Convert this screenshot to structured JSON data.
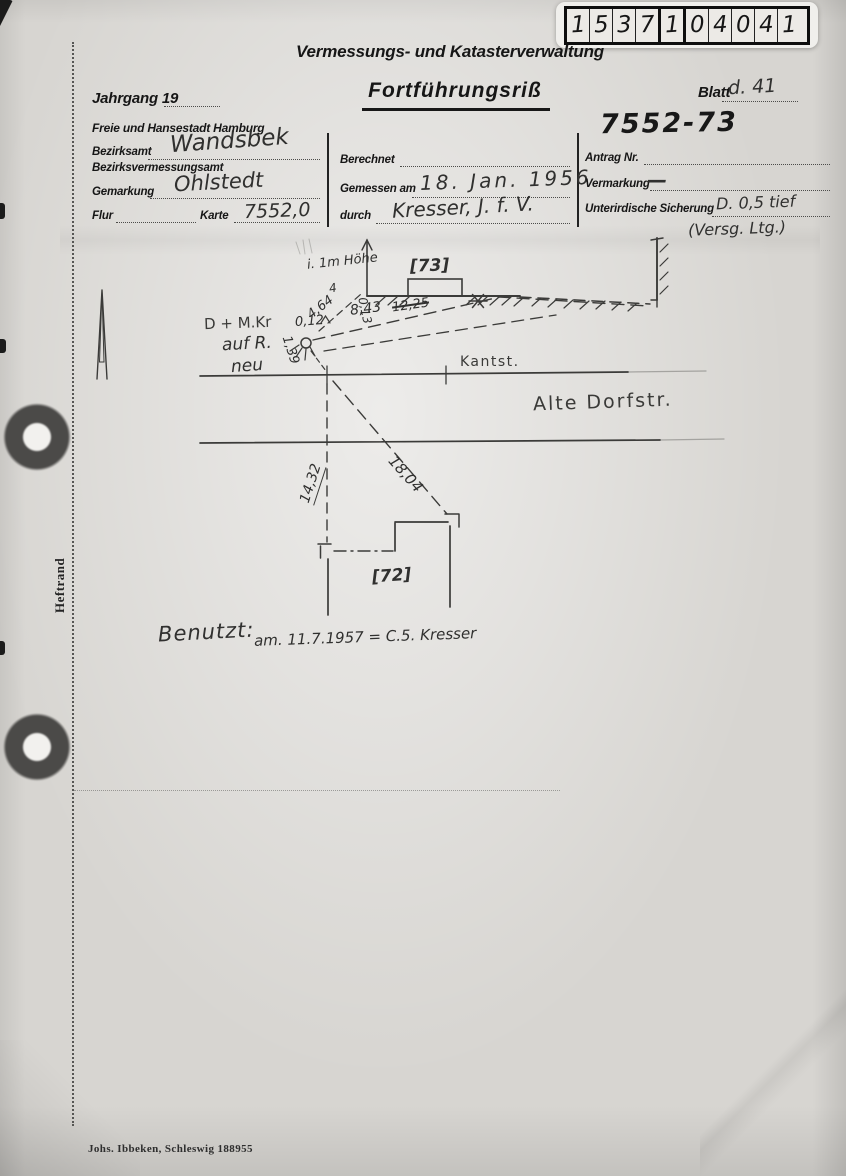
{
  "document": {
    "administration": "Vermessungs- und Katasterverwaltung",
    "jahrgang_label": "Jahrgang 19",
    "title": "Fortführungsriß",
    "blatt_label": "Blatt",
    "blatt_value": "d. 41",
    "city": "Freie und Hansestadt Hamburg",
    "file_number": "7552-73"
  },
  "stamp": {
    "digits": [
      "1",
      "5",
      "3",
      "7",
      "1",
      "0",
      "4",
      "0",
      "4",
      "1"
    ]
  },
  "form": {
    "bezirksamt_label": "Bezirksamt",
    "bezirksamt_value": "Wandsbek",
    "bezirksvermessungsamt_label": "Bezirksvermessungsamt",
    "gemarkung_label": "Gemarkung",
    "gemarkung_value": "Ohlstedt",
    "flur_label": "Flur",
    "karte_label": "Karte",
    "karte_value": "7552,0",
    "berechnet_label": "Berechnet",
    "gemessen_label": "Gemessen am",
    "gemessen_value": "18. Jan. 1956",
    "durch_label": "durch",
    "durch_value": "Kresser, J. f. V.",
    "antrag_label": "Antrag Nr.",
    "vermarkung_label": "Vermarkung",
    "vermarkung_value": "—",
    "sicherung_label": "Unterirdische Sicherung",
    "sicherung_value": "D. 0,5 tief",
    "sicherung_note": "(Versg. Ltg.)"
  },
  "sketch": {
    "parcel_73": "[73]",
    "parcel_72": "[72]",
    "curb_label": "Kantst.",
    "street_name": "Alte Dorfstr.",
    "height_note": "i. 1m Höhe",
    "point_note_line1": "D + M.Kr",
    "point_note_line2": "auf R.",
    "point_note_line3": "neu",
    "measure_4": "4",
    "measure_4_64": "4,64",
    "measure_0_13": "0,13",
    "measure_8_43": "8,43",
    "measure_12_25": "12,25",
    "measure_0_12": "0,12",
    "measure_1_39": "1,39",
    "measure_14_32": "14,32",
    "measure_18_04": "18,04"
  },
  "usage": {
    "label": "Benutzt:",
    "value": "am. 11.7.1957 = C.5. Kresser"
  },
  "margin": {
    "binding_label": "Heftrand"
  },
  "footer": {
    "printer": "Johs. Ibbeken, Schleswig 188955"
  },
  "colors": {
    "ink": "#2b2b2b",
    "paper": "#d7d5d1",
    "hole_ring": "#4b4a48"
  }
}
